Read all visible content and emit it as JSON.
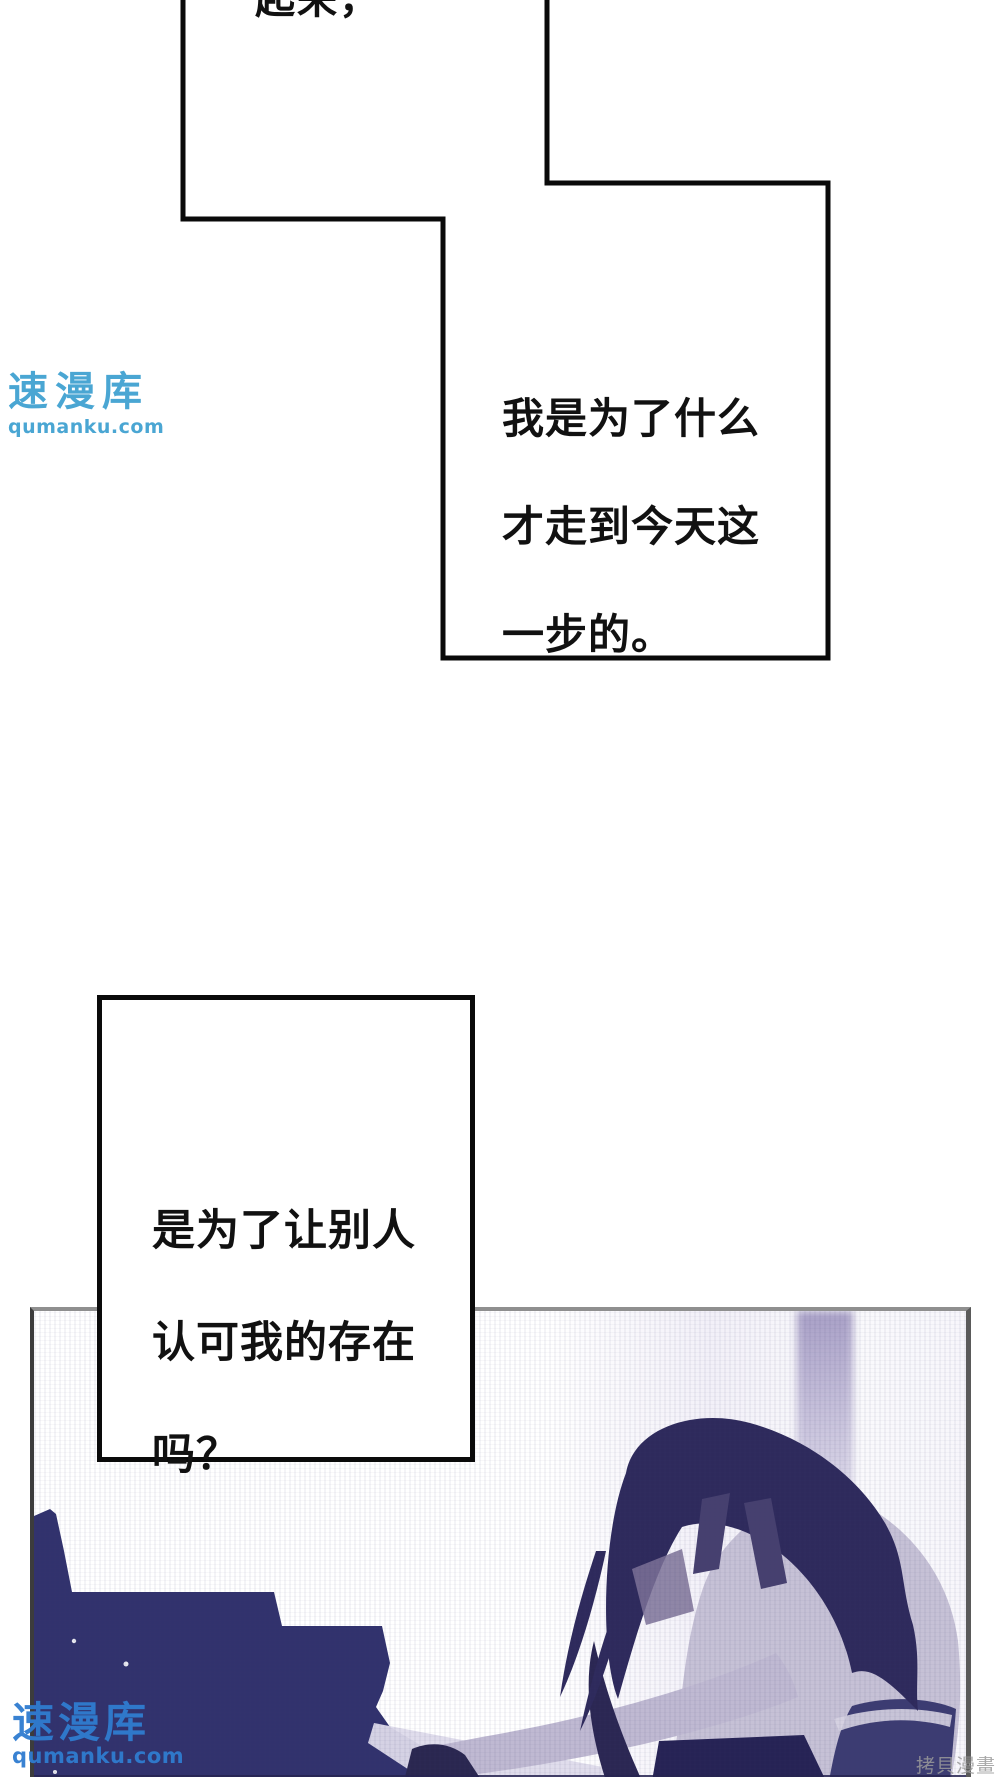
{
  "page": {
    "width": 1000,
    "height": 1777,
    "background": "#ffffff"
  },
  "panels": {
    "top_cut": {
      "text": "起来，"
    },
    "monologue1": {
      "lines": [
        "我是为了什么",
        "才走到今天这",
        "一步的。"
      ]
    },
    "monologue2": {
      "lines": [
        "是为了让别人",
        "认可我的存在",
        "吗？"
      ]
    }
  },
  "watermarks": {
    "upper": {
      "brand": "速漫库",
      "url": "qumanku.com",
      "color": "#3b9fd0"
    },
    "lower": {
      "brand": "速漫库",
      "url": "qumanku.com",
      "color": "#2f7cd0"
    }
  },
  "footer_credit": {
    "text": "拷貝漫畫",
    "color": "#9b9b9b"
  },
  "palette": {
    "panel_line": "#0a0a0a",
    "photo_border_top": "#8f8f8f",
    "photo_border_side": "#5a5a5a",
    "piano": "#31326d",
    "hair": "#2e2a5c",
    "shirt": "#c6c1d6",
    "arm": "#bfb9d2",
    "jeans": "#3c3c72",
    "light_streak": "#a39ac6",
    "keys": "#dedbeb"
  }
}
